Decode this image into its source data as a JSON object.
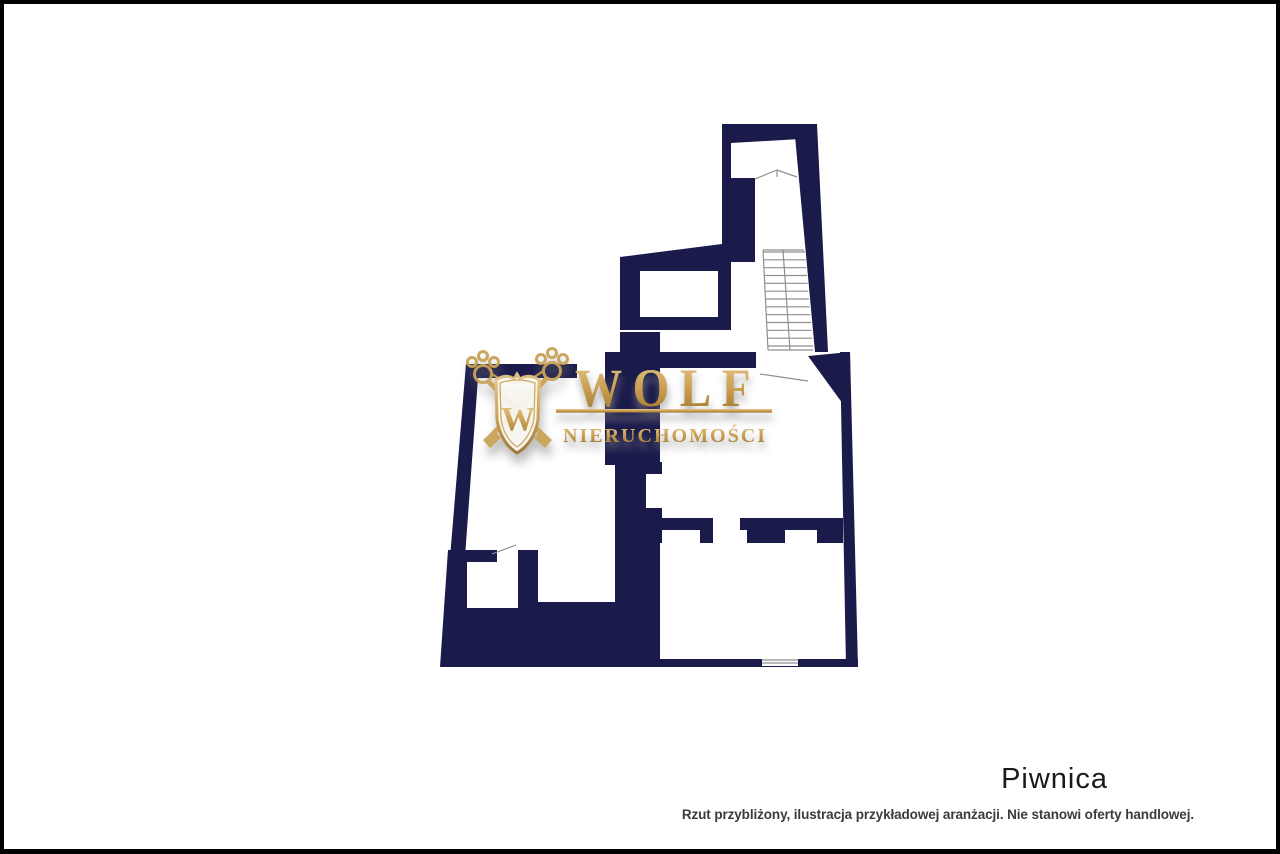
{
  "branding": {
    "logo_main": "WOLF",
    "logo_sub": "NIERUCHOMOŚCI",
    "crest_letter": "W"
  },
  "labels": {
    "floor_title": "Piwnica",
    "disclaimer": "Rzut przybliżony, ilustracja przykładowej aranżacji. Nie stanowi oferty handlowej."
  },
  "colors": {
    "wall_navy": "#1a1a4b",
    "gold_light": "#e6c98c",
    "gold_mid": "#c79b4b",
    "gold_dark": "#9a7230",
    "line_gray": "#8f8f8f",
    "frame_black": "#000000",
    "title_text": "#1a1a1a",
    "disclaimer_text": "#3b3b3b",
    "background": "#ffffff"
  },
  "floor_plan": {
    "navy_polygons": [
      {
        "name": "tower-top-wall",
        "pts": [
          [
            722,
            124
          ],
          [
            817,
            124
          ],
          [
            817,
            138
          ],
          [
            731,
            143
          ]
        ]
      },
      {
        "name": "tower-left-wall",
        "pts": [
          [
            722,
            124
          ],
          [
            731,
            124
          ],
          [
            731,
            246
          ],
          [
            722,
            246
          ]
        ]
      },
      {
        "name": "tower-inner-block",
        "pts": [
          [
            730,
            178
          ],
          [
            755,
            178
          ],
          [
            755,
            262
          ],
          [
            730,
            262
          ]
        ]
      },
      {
        "name": "tower-right-wall",
        "pts": [
          [
            795,
            136
          ],
          [
            817,
            124
          ],
          [
            828,
            352
          ],
          [
            815,
            352
          ]
        ]
      },
      {
        "name": "left-arm",
        "pts": [
          [
            620,
            257
          ],
          [
            722,
            244
          ],
          [
            731,
            244
          ],
          [
            731,
            330
          ],
          [
            620,
            330
          ]
        ]
      },
      {
        "name": "junction-wedge",
        "pts": [
          [
            808,
            356
          ],
          [
            850,
            352
          ],
          [
            851,
            415
          ]
        ]
      },
      {
        "name": "right-outer-wall",
        "pts": [
          [
            840,
            352
          ],
          [
            850,
            352
          ],
          [
            858,
            667
          ],
          [
            846,
            667
          ]
        ]
      },
      {
        "name": "top-wall-left",
        "pts": [
          [
            466,
            364
          ],
          [
            577,
            364
          ],
          [
            577,
            378
          ],
          [
            478,
            378
          ]
        ]
      },
      {
        "name": "top-wall-mid",
        "pts": [
          [
            657,
            352
          ],
          [
            756,
            352
          ],
          [
            756,
            368
          ],
          [
            657,
            368
          ]
        ]
      },
      {
        "name": "center-block",
        "pts": [
          [
            605,
            352
          ],
          [
            620,
            352
          ],
          [
            620,
            332
          ],
          [
            660,
            332
          ],
          [
            660,
            465
          ],
          [
            605,
            465
          ]
        ]
      },
      {
        "name": "center-column",
        "pts": [
          [
            615,
            462
          ],
          [
            662,
            462
          ],
          [
            662,
            604
          ],
          [
            615,
            604
          ]
        ]
      },
      {
        "name": "left-outer-wall",
        "pts": [
          [
            466,
            364
          ],
          [
            479,
            364
          ],
          [
            457,
            667
          ],
          [
            441,
            667
          ]
        ]
      },
      {
        "name": "bottom-mass",
        "pts": [
          [
            448,
            550
          ],
          [
            662,
            550
          ],
          [
            662,
            659
          ],
          [
            858,
            659
          ],
          [
            858,
            667
          ],
          [
            440,
            667
          ]
        ]
      },
      {
        "name": "mid-wall-left",
        "pts": [
          [
            658,
            518
          ],
          [
            713,
            518
          ],
          [
            713,
            543
          ],
          [
            700,
            543
          ],
          [
            700,
            530
          ],
          [
            658,
            530
          ]
        ]
      },
      {
        "name": "mid-wall-right",
        "pts": [
          [
            740,
            518
          ],
          [
            843,
            518
          ],
          [
            843,
            543
          ],
          [
            817,
            543
          ],
          [
            817,
            530
          ],
          [
            785,
            530
          ],
          [
            785,
            543
          ],
          [
            747,
            543
          ],
          [
            747,
            530
          ],
          [
            740,
            530
          ]
        ]
      }
    ],
    "white_cutouts": [
      {
        "name": "arm-room",
        "pts": [
          [
            640,
            271
          ],
          [
            718,
            271
          ],
          [
            718,
            317
          ],
          [
            640,
            317
          ]
        ]
      },
      {
        "name": "column-notch",
        "pts": [
          [
            646,
            474
          ],
          [
            662,
            474
          ],
          [
            662,
            508
          ],
          [
            646,
            508
          ]
        ]
      },
      {
        "name": "center-strip-room",
        "pts": [
          [
            538,
            549
          ],
          [
            615,
            549
          ],
          [
            615,
            602
          ],
          [
            538,
            602
          ]
        ]
      },
      {
        "name": "small-room",
        "pts": [
          [
            467,
            562
          ],
          [
            518,
            562
          ],
          [
            518,
            608
          ],
          [
            467,
            608
          ]
        ]
      },
      {
        "name": "small-room-door-gap",
        "pts": [
          [
            497,
            547
          ],
          [
            518,
            547
          ],
          [
            518,
            563
          ],
          [
            497,
            563
          ]
        ]
      },
      {
        "name": "bottom-center-room",
        "pts": [
          [
            660,
            543
          ],
          [
            690,
            543
          ],
          [
            690,
            659
          ],
          [
            660,
            659
          ]
        ]
      },
      {
        "name": "window-gap",
        "pts": [
          [
            762,
            659
          ],
          [
            798,
            659
          ],
          [
            798,
            666
          ],
          [
            762,
            666
          ]
        ]
      }
    ],
    "thin_lines": [
      {
        "name": "tower-break-line-l",
        "pts": [
          755,
          179,
          777,
          170
        ]
      },
      {
        "name": "tower-break-line-r",
        "pts": [
          777,
          170,
          797,
          177
        ]
      },
      {
        "name": "tower-break-tick",
        "pts": [
          777,
          170,
          777,
          177
        ]
      },
      {
        "name": "stairs-top-edge",
        "pts": [
          763,
          250,
          804,
          250
        ]
      },
      {
        "name": "stairs-left-edge",
        "pts": [
          763,
          250,
          768,
          350
        ]
      },
      {
        "name": "stairs-bottom-edge",
        "pts": [
          768,
          350,
          813,
          350
        ]
      },
      {
        "name": "stairs-divider",
        "pts": [
          783,
          250,
          790,
          350
        ]
      },
      {
        "name": "stairs-door-line",
        "pts": [
          760,
          374,
          808,
          381
        ]
      },
      {
        "name": "small-room-door-leaf",
        "pts": [
          492,
          554,
          516,
          545
        ]
      },
      {
        "name": "window-line-1",
        "pts": [
          762,
          660,
          798,
          660
        ]
      },
      {
        "name": "window-line-2",
        "pts": [
          762,
          663,
          798,
          663
        ]
      }
    ],
    "stairs": {
      "tread_count": 13,
      "y_top": 252,
      "y_bottom": 346,
      "x_left_top": 763,
      "x_left_bottom": 768,
      "x_right_top": 805,
      "x_right_bottom": 813
    }
  }
}
